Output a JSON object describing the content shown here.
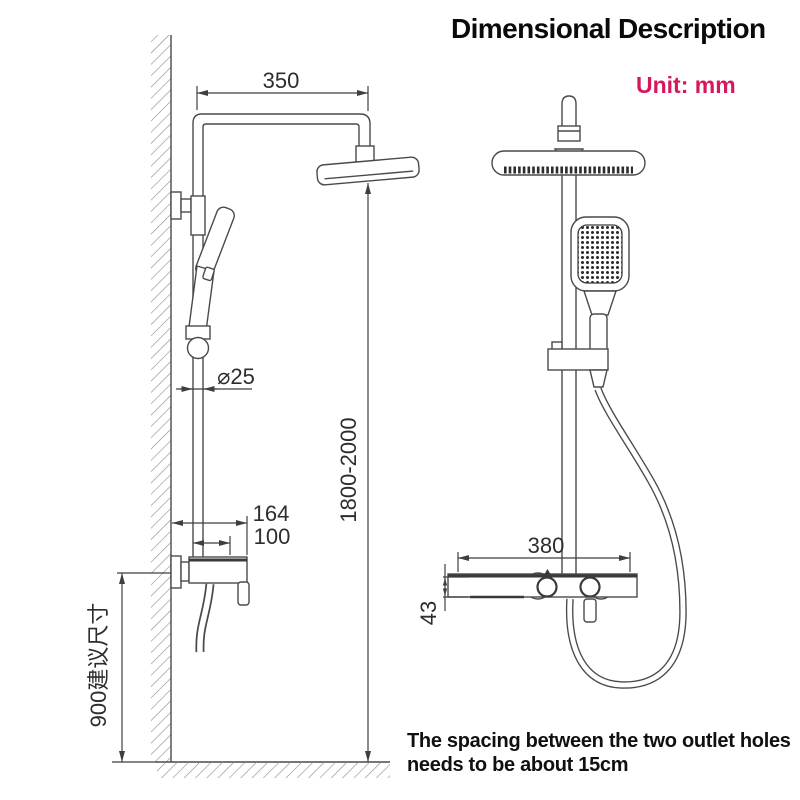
{
  "header": {
    "title": "Dimensional Description",
    "unit": "Unit: mm"
  },
  "left_view": {
    "dims": {
      "arm_length": "350",
      "pipe_diameter": "⌀25",
      "height_range": "1800-2000",
      "valve_width": "164",
      "outlet_offset": "100",
      "install_height": "900建议尺寸"
    }
  },
  "right_view": {
    "dims": {
      "bar_width": "380",
      "bar_height": "43"
    }
  },
  "note": {
    "line1": "The spacing between the two outlet holes",
    "line2": "needs to be about 15cm"
  },
  "colors": {
    "accent": "#d6175c",
    "line": "#4a4a4a",
    "text": "#101010"
  }
}
